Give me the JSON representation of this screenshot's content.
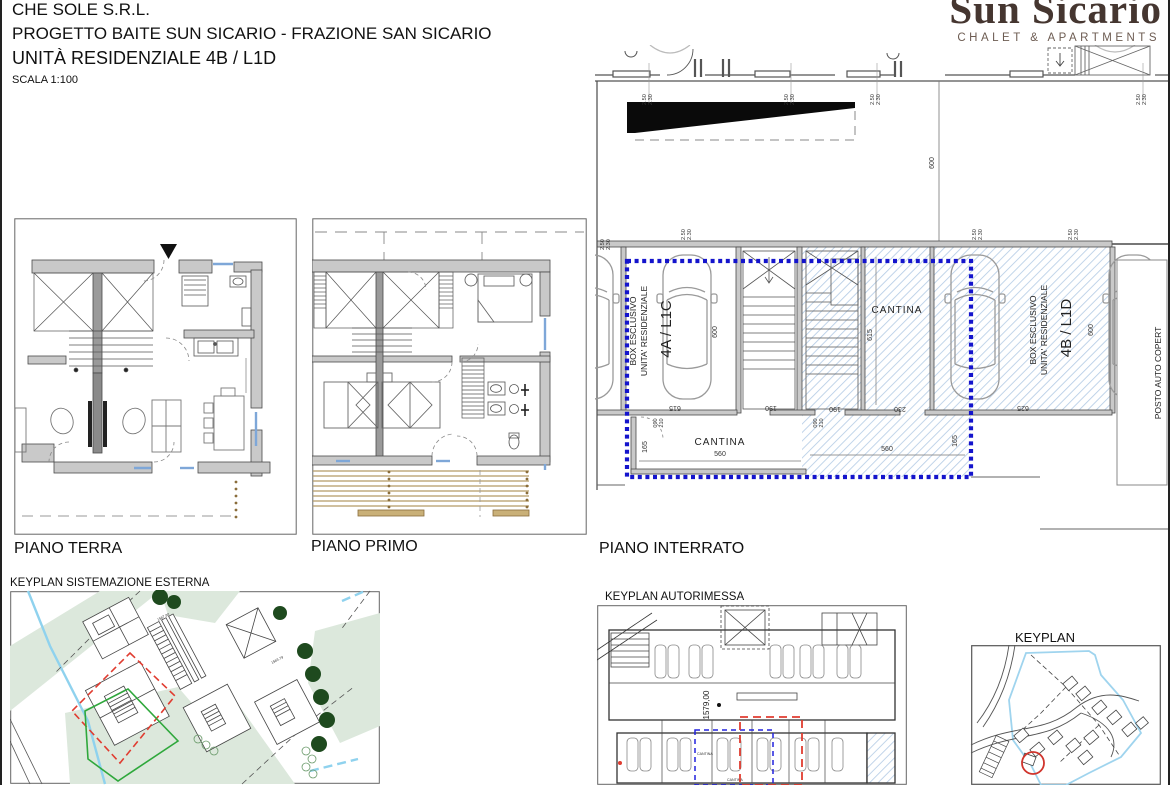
{
  "title_block": {
    "company": "CHE SOLE S.R.L.",
    "project": "PROGETTO BAITE SUN SICARIO - FRAZIONE SAN SICARIO",
    "unit": "UNITÀ RESIDENZIALE 4B / L1D",
    "scale": "SCALA 1:100"
  },
  "logo": {
    "name": "Sun Sicario",
    "tagline": "CHALET & APARTMENTS"
  },
  "plans": {
    "ground": {
      "label": "PIANO TERRA"
    },
    "first": {
      "label": "PIANO PRIMO"
    },
    "basement": {
      "label": "PIANO INTERRATO",
      "box_4a": {
        "line1": "BOX ESCLUSIVO",
        "line2": "UNITA' RESIDENZIALE",
        "unit": "4A / L1C"
      },
      "box_4b": {
        "line1": "BOX ESCLUSIVO",
        "line2": "UNITA' RESIDENZIALE",
        "unit": "4B / L1D"
      },
      "cantina_upper": "CANTINA",
      "cantina_lower": "CANTINA",
      "posto_auto": "POSTO AUTO COPERT",
      "dims": {
        "d600": "600",
        "d615": "615",
        "d190": "190",
        "d230": "230",
        "d625": "625",
        "d560": "560",
        "d165": "165",
        "h250": "2.50",
        "h230": "2.30",
        "door_w": "090",
        "door_h": "210"
      }
    }
  },
  "keyplans": {
    "esterna": {
      "label": "KEYPLAN SISTEMAZIONE ESTERNA",
      "elev1": "1587.90",
      "elev2": "1583.79"
    },
    "autorimessa": {
      "label": "KEYPLAN AUTORIMESSA",
      "elev": "1579,00",
      "cantina": "CANTINA"
    },
    "overview": {
      "label": "KEYPLAN"
    }
  },
  "colors": {
    "boundary_blue": "#1414cc",
    "hatch_blue": "#b6cde6",
    "window_blue": "#7ea7d8",
    "wall_gray": "#c9c9c9",
    "logo_brown": "#453630",
    "red_dashed": "#e03c30",
    "green_line": "#2fa83c",
    "cyan_line": "#8fd2ee",
    "area_green": "#dce8dc",
    "tree_green": "#1e4a1e",
    "deck_tan": "#b49b66"
  }
}
